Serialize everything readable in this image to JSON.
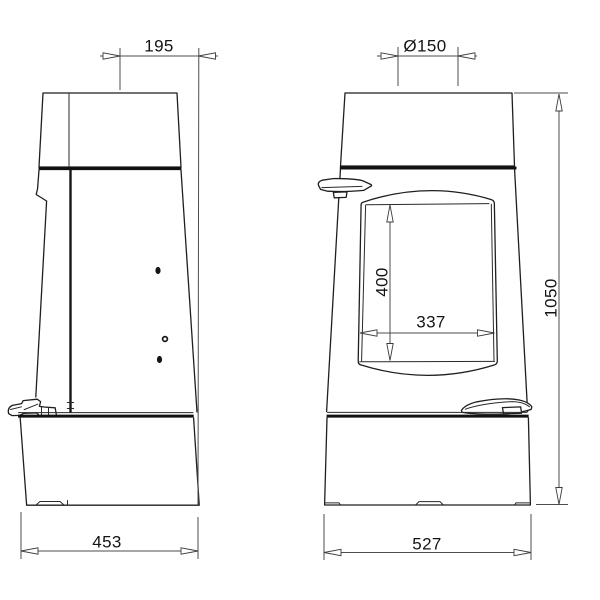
{
  "drawing": {
    "kind": "stove dimensional drawing, two orthographic views",
    "views": {
      "left": "side view",
      "right": "front view"
    }
  },
  "dimensions": {
    "flue_center_to_front": {
      "label": "195"
    },
    "flue_diameter": {
      "label": "Ø150"
    },
    "glass_height": {
      "label": "400"
    },
    "glass_width": {
      "label": "337"
    },
    "overall_height": {
      "label": "1050"
    },
    "overall_depth": {
      "label": "453"
    },
    "overall_width": {
      "label": "527"
    }
  },
  "colors": {
    "background": "#ffffff",
    "outline": "#1f1f1f",
    "dimension_line": "#4d4d4d",
    "text": "#141414"
  }
}
